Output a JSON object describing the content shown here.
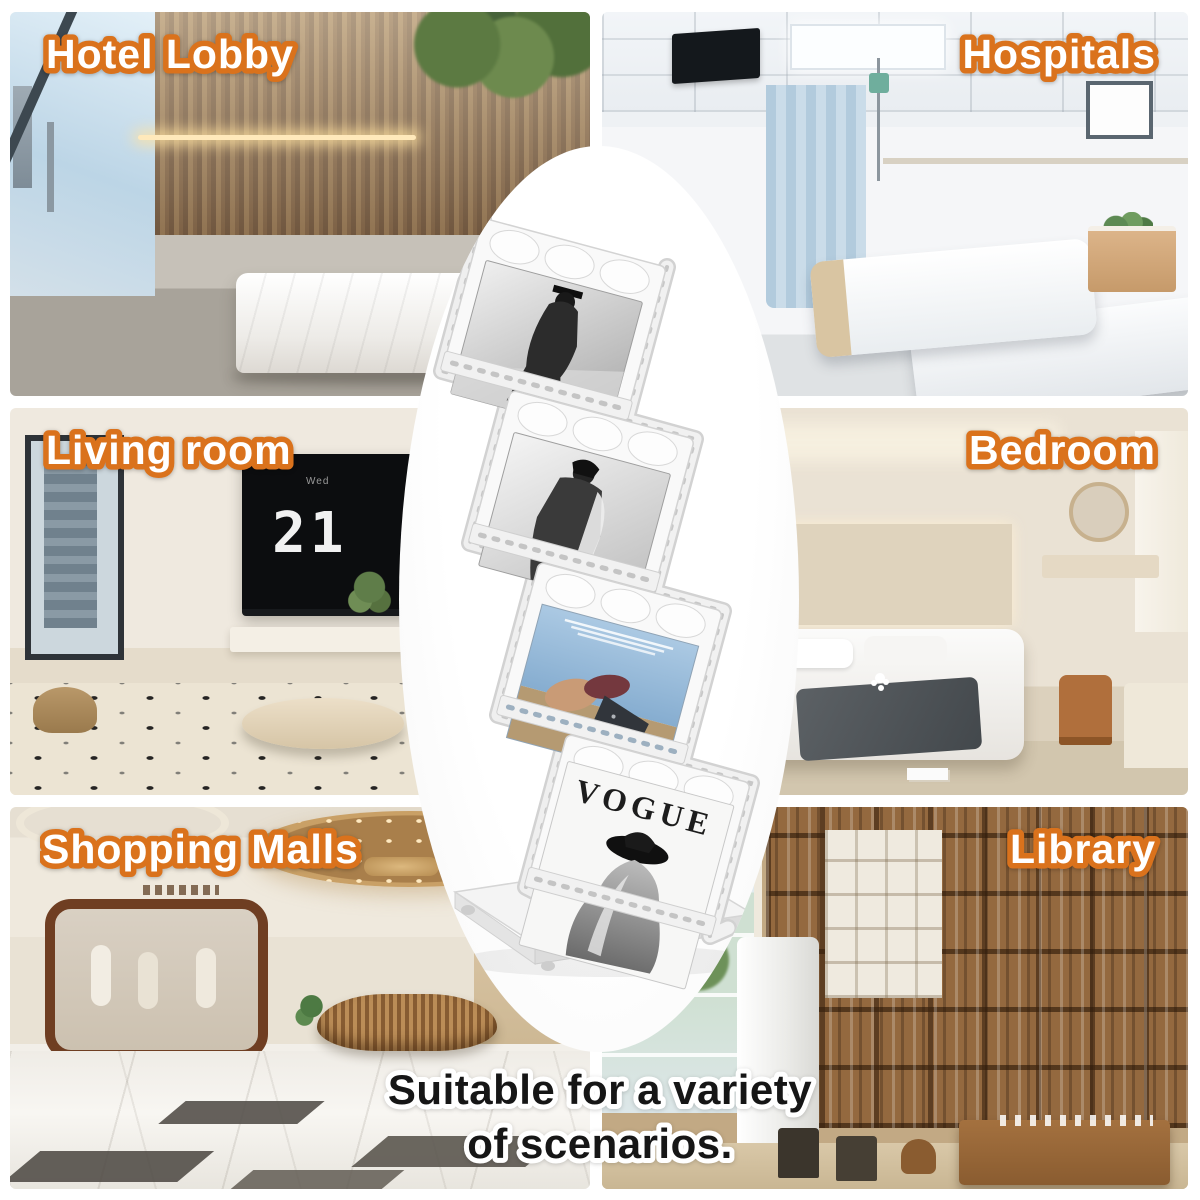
{
  "canvas": {
    "width": 1200,
    "height": 1200,
    "background_color": "#ffffff"
  },
  "style": {
    "label_text_color": "#ffffff",
    "label_outline_color": "#da721c",
    "caption_text_color": "#161616",
    "caption_outline_color": "#ffffff",
    "capsule_color": "#fdfdfd"
  },
  "tiles": [
    {
      "label": "Hotel Lobby",
      "position": "top-left",
      "label_side": "left"
    },
    {
      "label": "Hospitals",
      "position": "top-right",
      "label_side": "right"
    },
    {
      "label": "Living room",
      "position": "middle-left",
      "label_side": "left"
    },
    {
      "label": "Bedroom",
      "position": "middle-right",
      "label_side": "right"
    },
    {
      "label": "Shopping Malls",
      "position": "bottom-left",
      "label_side": "left"
    },
    {
      "label": "Library",
      "position": "bottom-right",
      "label_side": "right"
    }
  ],
  "caption": {
    "line1": "Suitable for a variety",
    "line2": "of scenarios."
  },
  "living_room_tv": {
    "day": "Wed",
    "time": "21 27"
  },
  "product": {
    "name": "white folding 4-tier magazine display rack",
    "magazines": [
      {
        "shelf": 1,
        "cover": "black-and-white fashion photo"
      },
      {
        "shelf": 2,
        "cover": "black-and-white fashion photo"
      },
      {
        "shelf": 3,
        "cover": "color magazine cover",
        "title_line1": "ДОРОГА",
        "title_line2": "К МОРЮ"
      },
      {
        "shelf": 4,
        "cover": "black-and-white magazine cover",
        "title": "VOGUE"
      }
    ]
  }
}
